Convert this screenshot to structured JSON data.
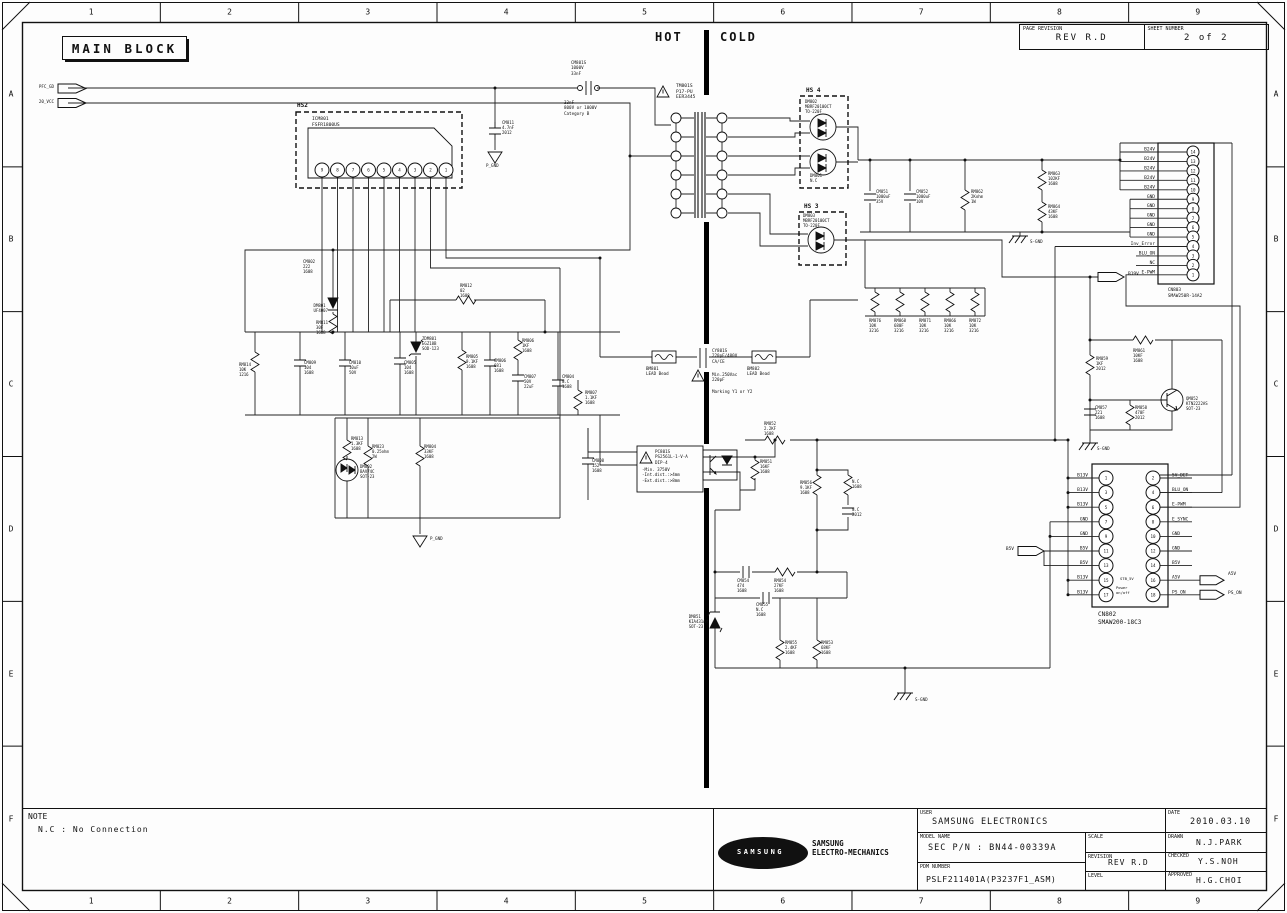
{
  "sheet": {
    "main_block_label": "MAIN BLOCK",
    "hot_label": "HOT",
    "cold_label": "COLD",
    "page_revision_label": "PAGE REVISION",
    "page_revision": "REV R.D",
    "sheet_number_label": "SHEET NUMBER",
    "sheet_number": "2 of 2",
    "note_title": "NOTE",
    "note_text": "N.C : No Connection"
  },
  "border": {
    "columns": [
      "1",
      "2",
      "3",
      "4",
      "5",
      "6",
      "7",
      "8",
      "9"
    ],
    "rows": [
      "A",
      "B",
      "C",
      "D",
      "E",
      "F"
    ]
  },
  "title_block": {
    "user_label": "USER",
    "user": "SAMSUNG ELECTRONICS",
    "date_label": "DATE",
    "date": "2010.03.10",
    "model_label": "MODEL NAME",
    "model": "SEC P/N : BN44-00339A",
    "scale_label": "SCALE",
    "scale": "",
    "revision_label": "REVISION",
    "revision": "REV R.D",
    "level_label": "LEVEL",
    "level": "",
    "pdm_label": "PDM NUMBER",
    "pdm": "PSLF211401A(P3237F1_ASM)",
    "drawn_label": "DRAWN",
    "drawn": "N.J.PARK",
    "checked_label": "CHECKED",
    "checked": "Y.S.NOH",
    "approved_label": "APPROVED",
    "approved": "H.G.CHOI",
    "logo_text": "SAMSUNG",
    "logo_company": "SAMSUNG\nELECTRO-MECHANICS"
  },
  "connectors": {
    "cn803": {
      "name": "CN803",
      "part": "SMAW250R-14A2",
      "pins": [
        {
          "n": "14",
          "signal": "B24V"
        },
        {
          "n": "13",
          "signal": "B24V"
        },
        {
          "n": "12",
          "signal": "B24V"
        },
        {
          "n": "11",
          "signal": "B24V"
        },
        {
          "n": "10",
          "signal": "B24V"
        },
        {
          "n": "9",
          "signal": "GND"
        },
        {
          "n": "8",
          "signal": "GND"
        },
        {
          "n": "7",
          "signal": "GND"
        },
        {
          "n": "6",
          "signal": "GND"
        },
        {
          "n": "5",
          "signal": "GND"
        },
        {
          "n": "4",
          "signal": "Inv_Error"
        },
        {
          "n": "3",
          "signal": "BLU_ON"
        },
        {
          "n": "2",
          "signal": "NC"
        },
        {
          "n": "1",
          "signal": "E-PWM"
        }
      ]
    },
    "cn802": {
      "name": "CN802",
      "part": "SMAW200-18C3",
      "left_pins": [
        {
          "n": "1",
          "signal": "B13V"
        },
        {
          "n": "3",
          "signal": "B13V"
        },
        {
          "n": "5",
          "signal": "B13V"
        },
        {
          "n": "7",
          "signal": "GND"
        },
        {
          "n": "9",
          "signal": "GND"
        },
        {
          "n": "11",
          "signal": "B5V"
        },
        {
          "n": "13",
          "signal": "B5V"
        },
        {
          "n": "15",
          "signal": "B13V"
        },
        {
          "n": "17",
          "signal": "B13V"
        }
      ],
      "right_pins": [
        {
          "n": "2",
          "signal": "5V_DET"
        },
        {
          "n": "4",
          "signal": "BLU_ON"
        },
        {
          "n": "6",
          "signal": "E-PWM"
        },
        {
          "n": "8",
          "signal": "E_SYNC"
        },
        {
          "n": "10",
          "signal": "GND"
        },
        {
          "n": "12",
          "signal": "GND"
        },
        {
          "n": "14",
          "signal": "B5V"
        },
        {
          "n": "16",
          "signal": "A5V"
        },
        {
          "n": "18",
          "signal": "PS_ON"
        }
      ],
      "inner_notes": [
        "STB_5V",
        "Power on/off"
      ]
    },
    "hs2_pins": [
      "9",
      "8",
      "7",
      "6",
      "5",
      "4",
      "3",
      "2",
      "1"
    ]
  },
  "schematic": {
    "labels": [
      {
        "t": "PFC_GD",
        "x": 54,
        "y": 84,
        "a": "r",
        "s": 4.2,
        "n": "port-pfc-gd"
      },
      {
        "t": "20_VCC",
        "x": 54,
        "y": 98.5,
        "a": "r",
        "s": 4.2,
        "n": "port-20-vcc"
      },
      {
        "t": "B19V",
        "x": 1128,
        "y": 272,
        "s": 4.5,
        "n": "port-b19v"
      },
      {
        "t": "B5V",
        "x": 1014,
        "y": 547,
        "a": "r",
        "s": 4.5,
        "n": "port-b5v"
      },
      {
        "t": "A5V",
        "x": 1228,
        "y": 572,
        "s": 4.5,
        "n": "port-a5v"
      },
      {
        "t": "PS_ON",
        "x": 1228,
        "y": 590.5,
        "s": 4.5,
        "n": "port-ps-on"
      },
      {
        "t": "HS2",
        "x": 297,
        "y": 102,
        "s": 6,
        "b": 1,
        "n": "hs2-title"
      },
      {
        "t": "ICM801\nFSFR1800US",
        "x": 312,
        "y": 117,
        "s": 4.6
      },
      {
        "t": "HS 4",
        "x": 806,
        "y": 87,
        "s": 6,
        "b": 1,
        "n": "hs4-title"
      },
      {
        "t": "DM802\nMBRF20100CT\nTO-220F",
        "x": 805,
        "y": 99,
        "s": 4
      },
      {
        "t": "DM801\nN.C",
        "x": 810,
        "y": 173,
        "s": 4
      },
      {
        "t": "HS 3",
        "x": 804,
        "y": 203,
        "s": 6,
        "b": 1,
        "n": "hs3-title"
      },
      {
        "t": "DM803\nMBRF20100CT\nTO-220F",
        "x": 803,
        "y": 213,
        "s": 4
      },
      {
        "t": "CM801S\n1000V\n33nF",
        "x": 571,
        "y": 60,
        "s": 4.2
      },
      {
        "t": "33nF\n800V or 1000V\nCategory B",
        "x": 564,
        "y": 100,
        "s": 4.2
      },
      {
        "t": "TM801S\nP17-PU\nEER3445",
        "x": 676,
        "y": 84,
        "s": 4.6
      },
      {
        "t": "CM851\n1000uF\n35V",
        "x": 876,
        "y": 189,
        "s": 4
      },
      {
        "t": "CM852\n1000uF\n10V",
        "x": 916,
        "y": 189,
        "s": 4
      },
      {
        "t": "RM862\n2Kohm\n1W",
        "x": 971,
        "y": 189,
        "s": 4
      },
      {
        "t": "RM863\n102KF\n1608",
        "x": 1048,
        "y": 171,
        "s": 4
      },
      {
        "t": "RM864\n43KF\n1608",
        "x": 1048,
        "y": 204,
        "s": 4
      },
      {
        "t": "S-GND",
        "x": 1030,
        "y": 239,
        "s": 4.2
      },
      {
        "t": "RM876\n10K\n3216",
        "x": 869,
        "y": 318,
        "s": 4
      },
      {
        "t": "RM868\n680F\n3216",
        "x": 894,
        "y": 318,
        "s": 4
      },
      {
        "t": "RM871\n10K\n3216",
        "x": 919,
        "y": 318,
        "s": 4
      },
      {
        "t": "RM866\n10K\n3216",
        "x": 944,
        "y": 318,
        "s": 4
      },
      {
        "t": "RM872\n10K\n3216",
        "x": 969,
        "y": 318,
        "s": 4
      },
      {
        "t": "RM861\n10KF\n1608",
        "x": 1133,
        "y": 348,
        "s": 4
      },
      {
        "t": "RM859\n1KF\n2012",
        "x": 1096,
        "y": 356,
        "s": 4
      },
      {
        "t": "QM852\nKTN2222AS\nSOT-23",
        "x": 1186,
        "y": 396,
        "s": 4
      },
      {
        "t": "CM857\n221\n1608",
        "x": 1095,
        "y": 405,
        "s": 4
      },
      {
        "t": "RM858\n470F\n2012",
        "x": 1135,
        "y": 405,
        "s": 4
      },
      {
        "t": "S-GND",
        "x": 1097,
        "y": 446,
        "s": 4.2
      },
      {
        "t": "BM801\nLEAD Bead",
        "x": 646,
        "y": 366,
        "s": 4.2
      },
      {
        "t": "CY801S\n220pF/400V\nCA/CE",
        "x": 712,
        "y": 348,
        "s": 4.2
      },
      {
        "t": "Min.250Vac\n220pF",
        "x": 712,
        "y": 372,
        "s": 4.2
      },
      {
        "t": "Marking Y1 or Y2",
        "x": 712,
        "y": 389,
        "s": 4.2
      },
      {
        "t": "BM802\nLEAD Bead",
        "x": 747,
        "y": 366,
        "s": 4.2
      },
      {
        "t": "PC801S\nPS2561L-1-V-A\nDIP-4",
        "x": 655,
        "y": 449,
        "s": 4.2
      },
      {
        "t": "-Min. 3750V\n-Int.dist.:>4mm\n-Ext.dist.:>8mm",
        "x": 642,
        "y": 467,
        "s": 4.2
      },
      {
        "t": "RM851\n16KF\n1608",
        "x": 760,
        "y": 459,
        "s": 4
      },
      {
        "t": "RM852\n2.2KF\n1608",
        "x": 764,
        "y": 421,
        "s": 4
      },
      {
        "t": "RM856\n9.1KF\n1608",
        "x": 812,
        "y": 480,
        "a": "r",
        "s": 4
      },
      {
        "t": "N.C\n1608",
        "x": 852,
        "y": 479,
        "s": 4
      },
      {
        "t": "N.C\n2012",
        "x": 852,
        "y": 507,
        "s": 4
      },
      {
        "t": "CM854\n474\n1608",
        "x": 737,
        "y": 578,
        "s": 4
      },
      {
        "t": "RM854\n27KF\n1608",
        "x": 774,
        "y": 578,
        "s": 4
      },
      {
        "t": "CM855\nN.C\n1608",
        "x": 756,
        "y": 602,
        "s": 4
      },
      {
        "t": "DM851\nKIA431AM\nSOT-23",
        "x": 708,
        "y": 614,
        "a": "r",
        "s": 4
      },
      {
        "t": "RM855\n2.4KF\n1608",
        "x": 785,
        "y": 640,
        "s": 4
      },
      {
        "t": "RM853\n68KF\n1608",
        "x": 821,
        "y": 640,
        "s": 4
      },
      {
        "t": "S-GND",
        "x": 915,
        "y": 697,
        "s": 4.2
      },
      {
        "t": "RM813\n1.3KF\n1608",
        "x": 351,
        "y": 436,
        "s": 4
      },
      {
        "t": "DM802\nBAV74C\nSOT-23",
        "x": 360,
        "y": 464,
        "s": 4
      },
      {
        "t": "RM823\n0.25ohm\n2W",
        "x": 372,
        "y": 444,
        "s": 4
      },
      {
        "t": "RM804\n33KF\n1608",
        "x": 424,
        "y": 444,
        "s": 4
      },
      {
        "t": "P_GND",
        "x": 430,
        "y": 536,
        "s": 4.2
      },
      {
        "t": "CM808\n152\n1608",
        "x": 592,
        "y": 458,
        "s": 4
      },
      {
        "t": "DM801\nUF4007",
        "x": 328,
        "y": 303,
        "a": "r",
        "s": 4
      },
      {
        "t": "RM811\n30F\n1608",
        "x": 328,
        "y": 320,
        "a": "r",
        "s": 4
      },
      {
        "t": "ZDM801\nEGZ18B\nSOD-123",
        "x": 422,
        "y": 336,
        "s": 4
      },
      {
        "t": "RM812\n02\n1608",
        "x": 460,
        "y": 283,
        "s": 4
      },
      {
        "t": "RM814\n10K\n1216",
        "x": 251,
        "y": 362,
        "a": "r",
        "s": 4
      },
      {
        "t": "CM809\n104\n1608",
        "x": 304,
        "y": 360,
        "s": 4
      },
      {
        "t": "CM810\n10uF\n50V",
        "x": 349,
        "y": 360,
        "s": 4
      },
      {
        "t": "CM805\n104\n1608",
        "x": 404,
        "y": 360,
        "s": 4
      },
      {
        "t": "RM805\n9.1KF\n1608",
        "x": 466,
        "y": 354,
        "s": 4
      },
      {
        "t": "CM806\n681\n1608",
        "x": 494,
        "y": 358,
        "s": 4
      },
      {
        "t": "RM806\n1KF\n1608",
        "x": 522,
        "y": 338,
        "s": 4
      },
      {
        "t": "CM807\n50V\n22uF",
        "x": 524,
        "y": 374,
        "s": 4
      },
      {
        "t": "CM804\nN.C\n1608",
        "x": 562,
        "y": 374,
        "s": 4
      },
      {
        "t": "RM807\n1.1KF\n1608",
        "x": 585,
        "y": 390,
        "s": 4
      },
      {
        "t": "CM802\n222\n1608",
        "x": 303,
        "y": 259,
        "s": 4
      },
      {
        "t": "CM811\n4.7nF\n2012",
        "x": 502,
        "y": 120,
        "s": 4
      },
      {
        "t": "P_GND",
        "x": 486,
        "y": 163,
        "s": 4.2
      },
      {
        "t": "CN803\nSMAW250R-14A2",
        "x": 1185,
        "y": 288,
        "a": "c",
        "s": 4.4,
        "n": "cn803-label"
      },
      {
        "t": "CN802\nSMAW200-18C3",
        "x": 1098,
        "y": 611,
        "s": 6,
        "n": "cn802-label"
      },
      {
        "t": "STB_5V",
        "x": 1120,
        "y": 577,
        "s": 3.8
      },
      {
        "t": "Power\non/off",
        "x": 1116,
        "y": 586,
        "s": 3.8
      }
    ]
  }
}
